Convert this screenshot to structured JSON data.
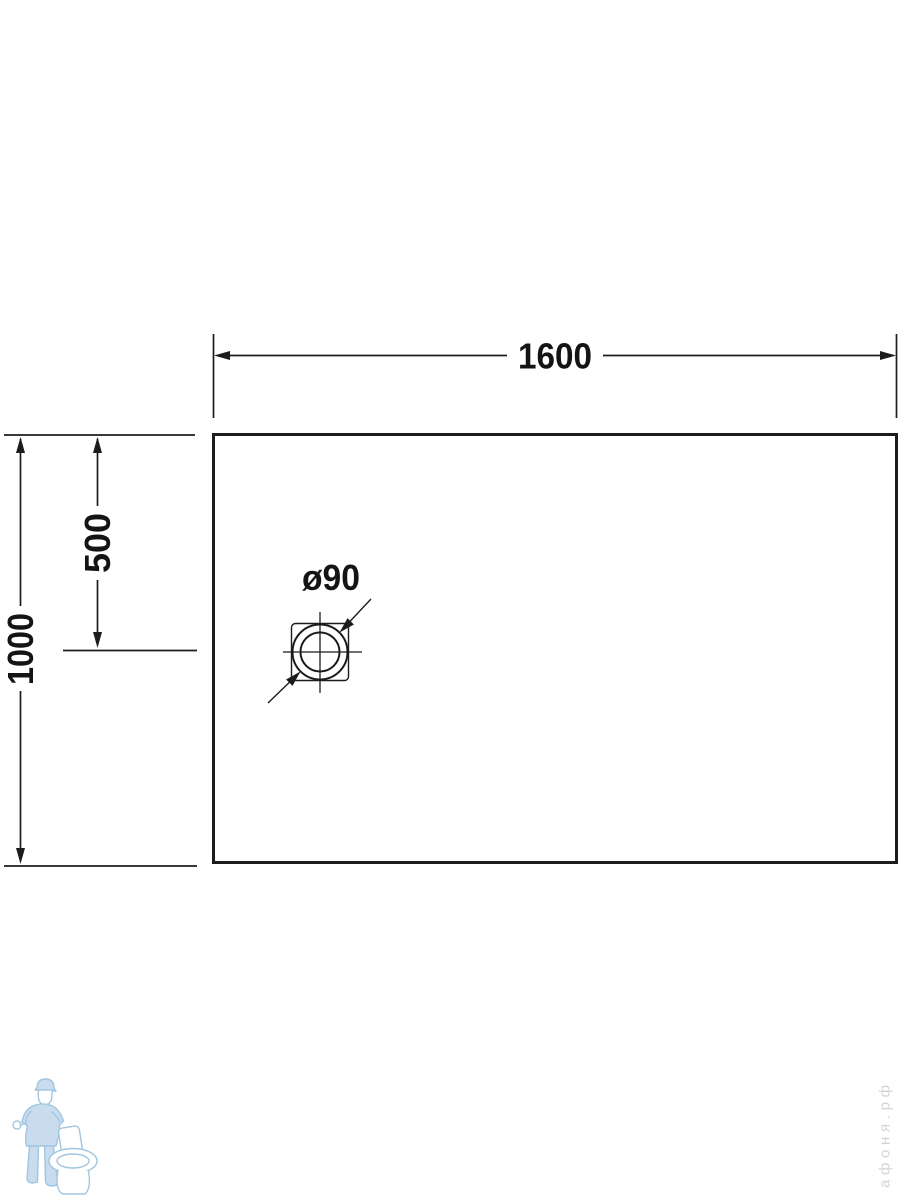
{
  "colors": {
    "line": "#1c1c1c",
    "text": "#141414",
    "watermark_blue": "#a2c6e0",
    "watermark_blue_fill": "#c8dcee",
    "watermark_gray": "#d4d4d4"
  },
  "dimensions": {
    "overall_width": "1600",
    "overall_depth": "1000",
    "drain_offset_from_top": "500",
    "drain_diameter": "ø90"
  },
  "watermark": {
    "site_text": "афоня.рф"
  }
}
